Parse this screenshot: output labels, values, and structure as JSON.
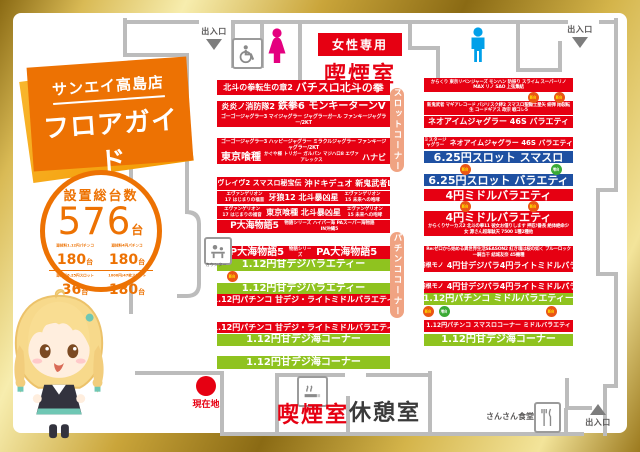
{
  "brand": {
    "store": "サンエイ高島店",
    "title": "フロアガイド",
    "subtitle": "SAN-EI TAKASHIMA FLOOR GUIDE"
  },
  "stats": {
    "heading": "設置総台数",
    "total": "576",
    "total_unit": "台",
    "items": [
      {
        "label": "遊技料1.12円パチンコ",
        "value": "180",
        "unit": "台"
      },
      {
        "label": "遊技料4円パチンコ",
        "value": "180",
        "unit": "台"
      },
      {
        "label": "遊技料6.25円スロット",
        "value": "36",
        "unit": "台"
      },
      {
        "label": "1000円/47枚スロット",
        "value": "180",
        "unit": "台"
      }
    ]
  },
  "corners": {
    "slot": "スロットコーナー",
    "pachinko": "パチンココーナー"
  },
  "labels": {
    "entrance": "出入口",
    "women_only": "女性専用",
    "smoking_room": "喫煙室",
    "rest_room": "休憩室",
    "dining": "さんさん食堂",
    "counter": "カウンター",
    "current_location": "現在地"
  },
  "badges": {
    "new": "新台",
    "add": "増台"
  },
  "rows": {
    "left": {
      "l1": {
        "a": "北斗の拳転生の章2",
        "b": "バチスロ北斗の拳"
      },
      "l2": {
        "a": "炎炎ノ消防隊2",
        "b": "鉄拳6 モンキーターンV"
      },
      "l3": {
        "t": "ゴーゴージャグラー3 マイジャグラー ジャグラーガール ファンキージャグラー/2KT"
      },
      "l4": {
        "t": "ゴーゴージャグラー3 ハッピージャグラー ミラクルジャグラー ファンキージャグラー/2KT"
      },
      "l5": {
        "a": "東京喰種",
        "b": "かぐや様 トリガー ガルパン マジハロ8 エヴァ アレックス",
        "c": "ハナビ"
      },
      "l6": {
        "a": "ヴァルヴレイヴ2 スマスロ秘宝伝",
        "b": "沖ドキデュオ 新鬼武者LUCK"
      },
      "l7": {
        "a": "エヴァンゲリオン17 はじまりの福音",
        "b": "牙狼12 北斗暴凶星",
        "c": "エヴァンゲリオン15 未来への咆哮"
      },
      "l8": {
        "a": "エヴァンゲリオン17 はじまりの福音",
        "b": "東京喰種 北斗暴凶星",
        "c": "エヴァンゲリオン15 未来への咆哮"
      },
      "l9": {
        "a": "P大海物語5",
        "b": "物語シリーズ ハイパー海 PAスーパー海物語IN沖縄5"
      },
      "l10": {
        "a": "P大海物語5",
        "b": "物語シリーズ",
        "c": "PA大海物語5"
      },
      "l11": {
        "t": "1.12円甘デジバラエティー"
      },
      "l12": {
        "t": "1.12円甘デジバラエティー"
      },
      "l13": {
        "t": "1.12円パチンコ 甘デジ・ライトミドルバラエティ"
      },
      "l14": {
        "t": "1.12円パチンコ 甘デジ・ライトミドルバラエティ"
      },
      "l15": {
        "t": "1.12円甘デジ海コーナー"
      },
      "l16": {
        "t": "1.12円甘デジ海コーナー"
      }
    },
    "right": {
      "r1": {
        "t": "からくり 東京リベンジャーズ モンハン 防振り スライム スーパーリノMAX リノ SAO 上弦集結"
      },
      "r2": {
        "t": "新鬼武者 マギアレコード バジリスク絆2 スマスロ聖闘士星矢 緋弾 翔裂転生 コードギアス 政宗 戦コレ5"
      },
      "r3": {
        "t": "ネオアイムジャグラー 46S バラエティ"
      },
      "r4": {
        "a": "ミスタージャグラー",
        "b": "ネオアイムジャグラー 46S バラエティ"
      },
      "r5": {
        "t": "6.25円スロット スマスロ"
      },
      "r6": {
        "t": "6.25円スロット バラエティ"
      },
      "r7": {
        "t": "4円ミドルバラエティ"
      },
      "r8": {
        "t": "4円ミドルバラエティ"
      },
      "r9": {
        "t": "からくりサーカス2 北斗の拳11 彼女お借りします 押忍!番長 絶体絶命少女 源さん超韋駄天 7500 1種2種他"
      },
      "r10": {
        "t": "Re:ゼロから始める異世界生活SEASON2 紅き魂は桜の如く ブルーロック 一騎当千 結城友奈 45機種"
      },
      "r11": {
        "a": "羽根モノ",
        "b": "4円甘デジバラ4円ライトミドルバラ"
      },
      "r12": {
        "a": "羽根モノ",
        "b": "4円甘デジバラ4円ライトミドルバラ"
      },
      "r13": {
        "t": "1.12円パチンコ ミドルバラエティー"
      },
      "r14": {
        "t": "1.12円パチンコ スマスロコーナー ミドルバラエティ"
      },
      "r15": {
        "t": "1.12円甘デジ海コーナー"
      }
    }
  },
  "colors": {
    "accent": "#ed7203",
    "red": "#e60012",
    "green": "#8fc31f",
    "blue": "#1e50a2",
    "pill": "#f0a382",
    "pink": "#e4007f",
    "cyan": "#00a0e9",
    "gold": "#c9a545"
  }
}
